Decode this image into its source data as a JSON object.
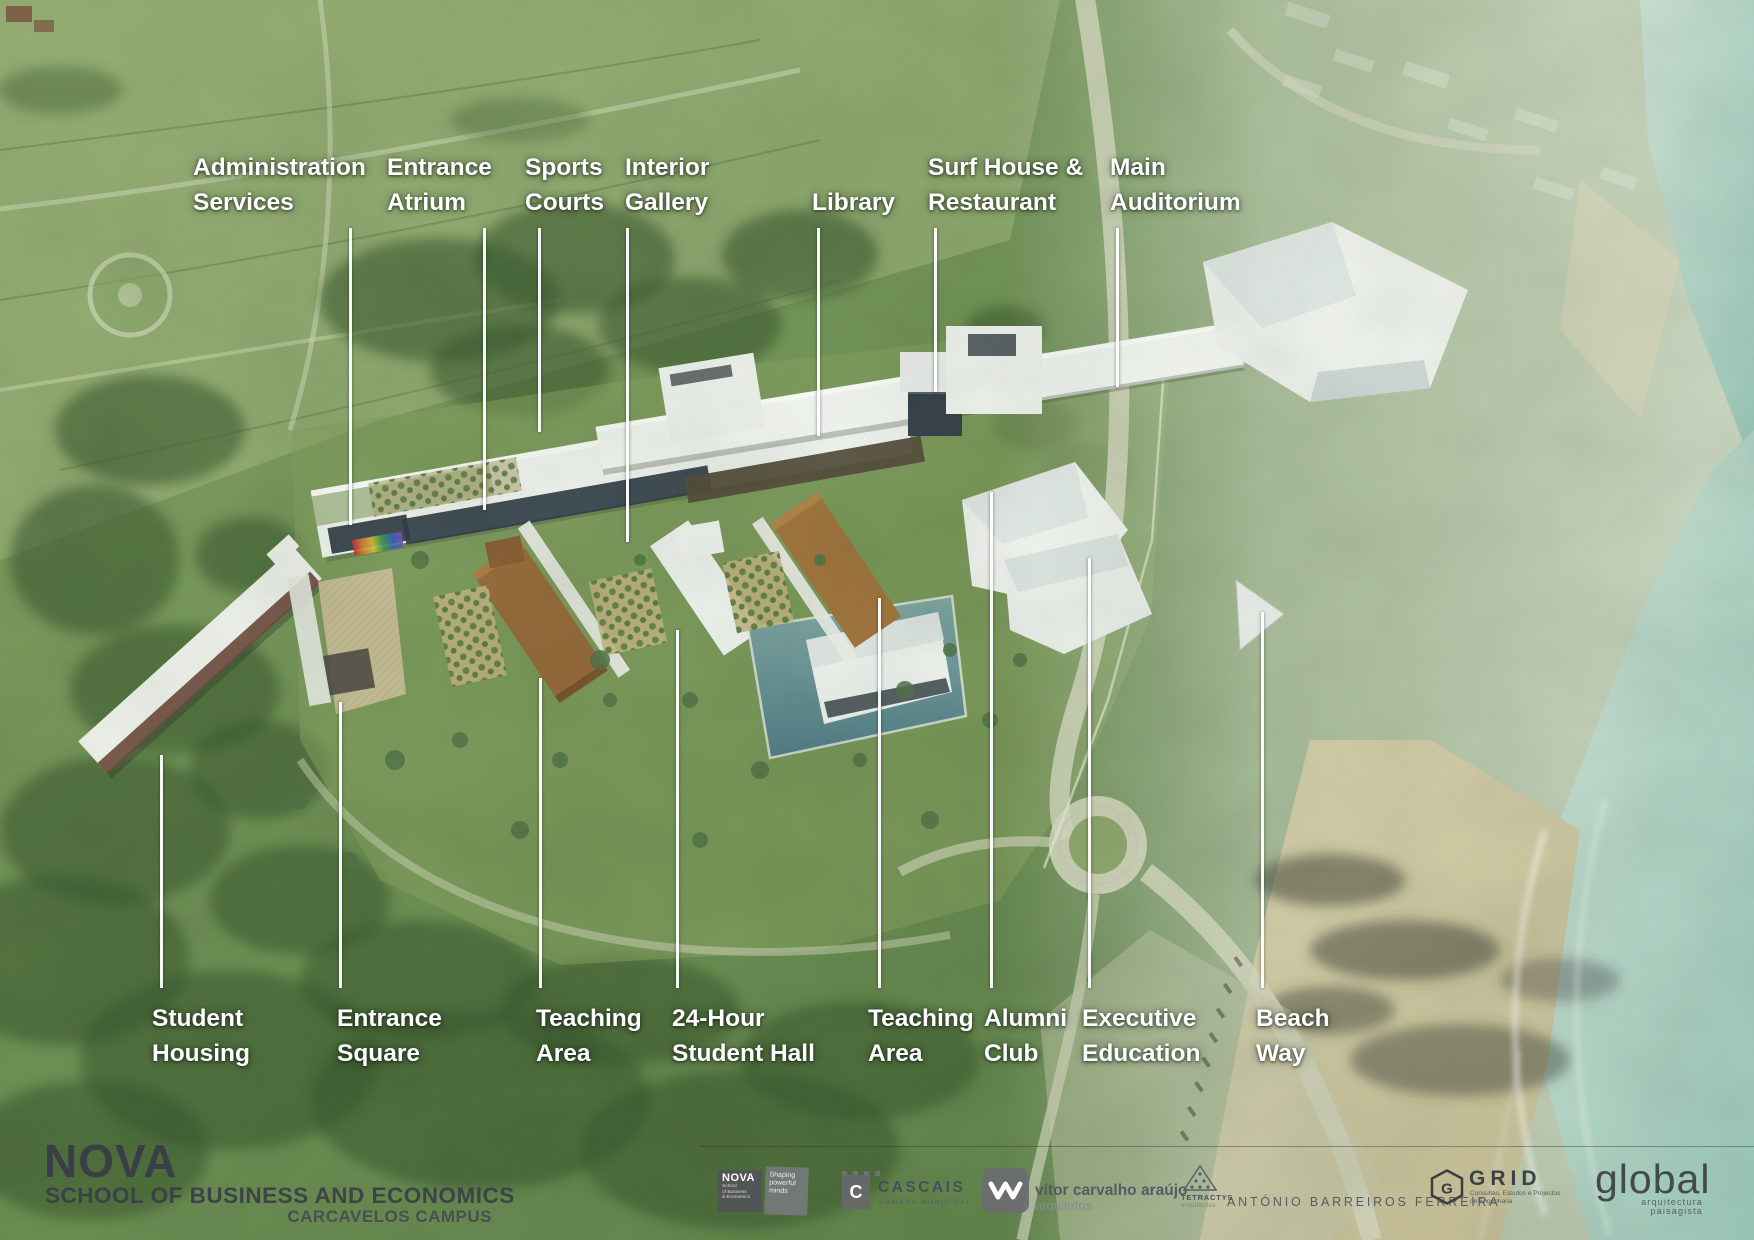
{
  "scene": {
    "description": "Aerial architectural rendering of a coastal campus with labelled buildings",
    "colors": {
      "label_text": "#ffffff",
      "brand_text": "#3a3e48",
      "vegetation": "#6b8f55",
      "water": "#a9cfc5",
      "sand": "#d6cda9",
      "building_white": "#f2f4f3",
      "roof_brown": "#9a6d3c",
      "pool": "#6f989a"
    }
  },
  "callouts": {
    "top": [
      {
        "id": "administration-services",
        "line1": "Administration",
        "line2": "Services"
      },
      {
        "id": "entrance-atrium",
        "line1": "Entrance",
        "line2": "Atrium"
      },
      {
        "id": "sports-courts",
        "line1": "Sports",
        "line2": "Courts"
      },
      {
        "id": "interior-gallery",
        "line1": "Interior",
        "line2": "Gallery"
      },
      {
        "id": "library",
        "line1": "Library",
        "line2": ""
      },
      {
        "id": "surf-house-restaurant",
        "line1": "Surf House &",
        "line2": "Restaurant"
      },
      {
        "id": "main-auditorium",
        "line1": "Main",
        "line2": "Auditorium"
      }
    ],
    "bottom": [
      {
        "id": "student-housing",
        "line1": "Student",
        "line2": "Housing"
      },
      {
        "id": "entrance-square",
        "line1": "Entrance",
        "line2": "Square"
      },
      {
        "id": "teaching-area-west",
        "line1": "Teaching",
        "line2": "Area"
      },
      {
        "id": "24-hour-student-hall",
        "line1": "24-Hour",
        "line2": "Student Hall"
      },
      {
        "id": "teaching-area-east",
        "line1": "Teaching",
        "line2": "Area"
      },
      {
        "id": "alumni-club",
        "line1": "Alumni",
        "line2": "Club"
      },
      {
        "id": "executive-education",
        "line1": "Executive",
        "line2": "Education"
      },
      {
        "id": "beach-way",
        "line1": "Beach",
        "line2": "Way"
      }
    ]
  },
  "footer": {
    "brand": {
      "name": "NOVA",
      "school": "SCHOOL OF BUSINESS AND ECONOMICS",
      "campus": "CARCAVELOS CAMPUS"
    },
    "logos": {
      "nova_box": {
        "name": "NOVA",
        "sub1": "School",
        "sub2": "of Business",
        "sub3": "& Economics"
      },
      "shaping_box": {
        "line1": "Shaping",
        "line2": "powerful",
        "line3": "minds"
      },
      "cascais": {
        "initial": "C",
        "name": "CASCAIS",
        "sub": "CÂMARA MUNICIPAL"
      },
      "vitor": {
        "name": "vítor carvalho araújo",
        "sub": "arquitetos"
      },
      "tetractys": {
        "name": "TETRACTYS",
        "sub": "arquitectos"
      },
      "antonio": {
        "name": "ANTÓNIO BARREIROS FERREIRA"
      },
      "grid": {
        "name": "GRID",
        "sub1": "Consultas, Estudos e Projectos",
        "sub2": "de Engenharia"
      },
      "global": {
        "name": "global",
        "sub": "arquitectura paisagista"
      }
    }
  }
}
